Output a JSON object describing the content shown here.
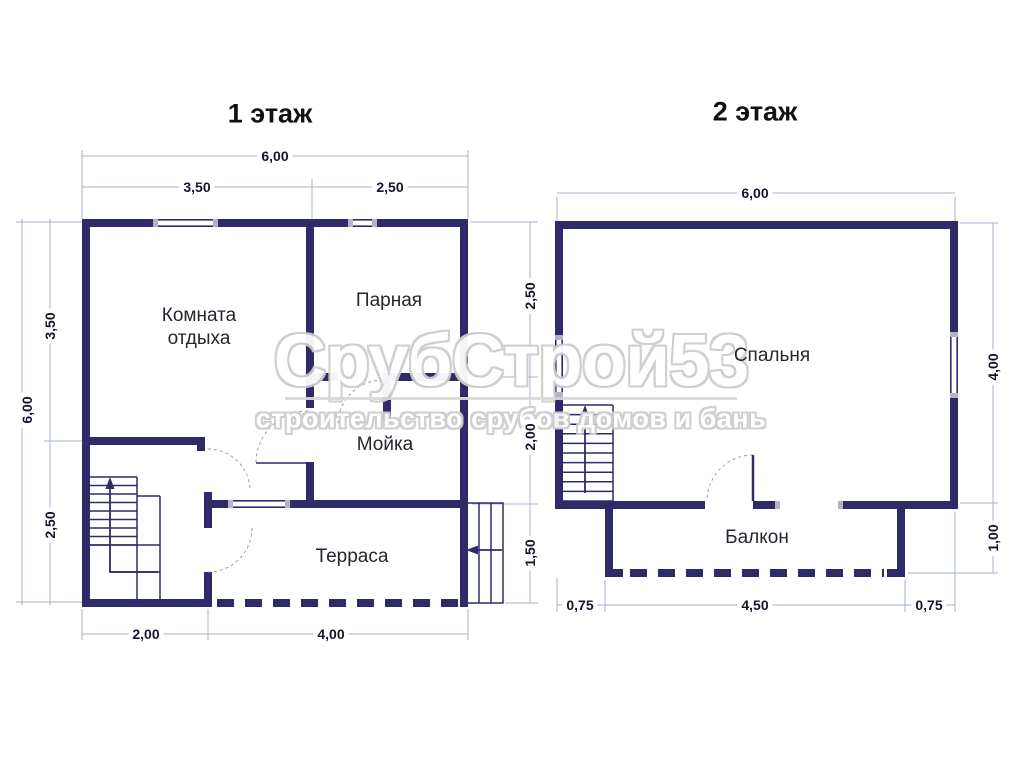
{
  "floor1": {
    "title": "1 этаж",
    "rooms": {
      "rest_line1": "Комната",
      "rest_line2": "отдыха",
      "steam": "Парная",
      "wash": "Мойка",
      "terrace": "Терраса"
    },
    "dims": {
      "top_total": "6,00",
      "top_left": "3,50",
      "top_right": "2,50",
      "left_total": "6,00",
      "left_upper": "3,50",
      "left_lower": "2,50",
      "right_upper": "2,50",
      "right_middle": "2,00",
      "right_lower": "1,50",
      "bottom_left": "2,00",
      "bottom_right": "4,00"
    }
  },
  "floor2": {
    "title": "2 этаж",
    "rooms": {
      "bedroom": "Спальня",
      "balcony": "Балкон"
    },
    "dims": {
      "top_total": "6,00",
      "right_upper": "4,00",
      "right_lower": "1,00",
      "bottom_left": "0,75",
      "bottom_center": "4,50",
      "bottom_right": "0,75"
    }
  },
  "watermark": {
    "brand": "СрубСтрой53",
    "tagline": "строительство срубов домов и бань"
  },
  "icons": {
    "stairs-up-arrow": "↑",
    "entrance-arrow": "←"
  },
  "colors": {
    "wall": "#2e2b68",
    "dim_line": "#a6b2cf",
    "window_cap": "#b4b4c4",
    "door_arc": "#9aa0ae",
    "watermark_outline": "#cdcdcd"
  }
}
